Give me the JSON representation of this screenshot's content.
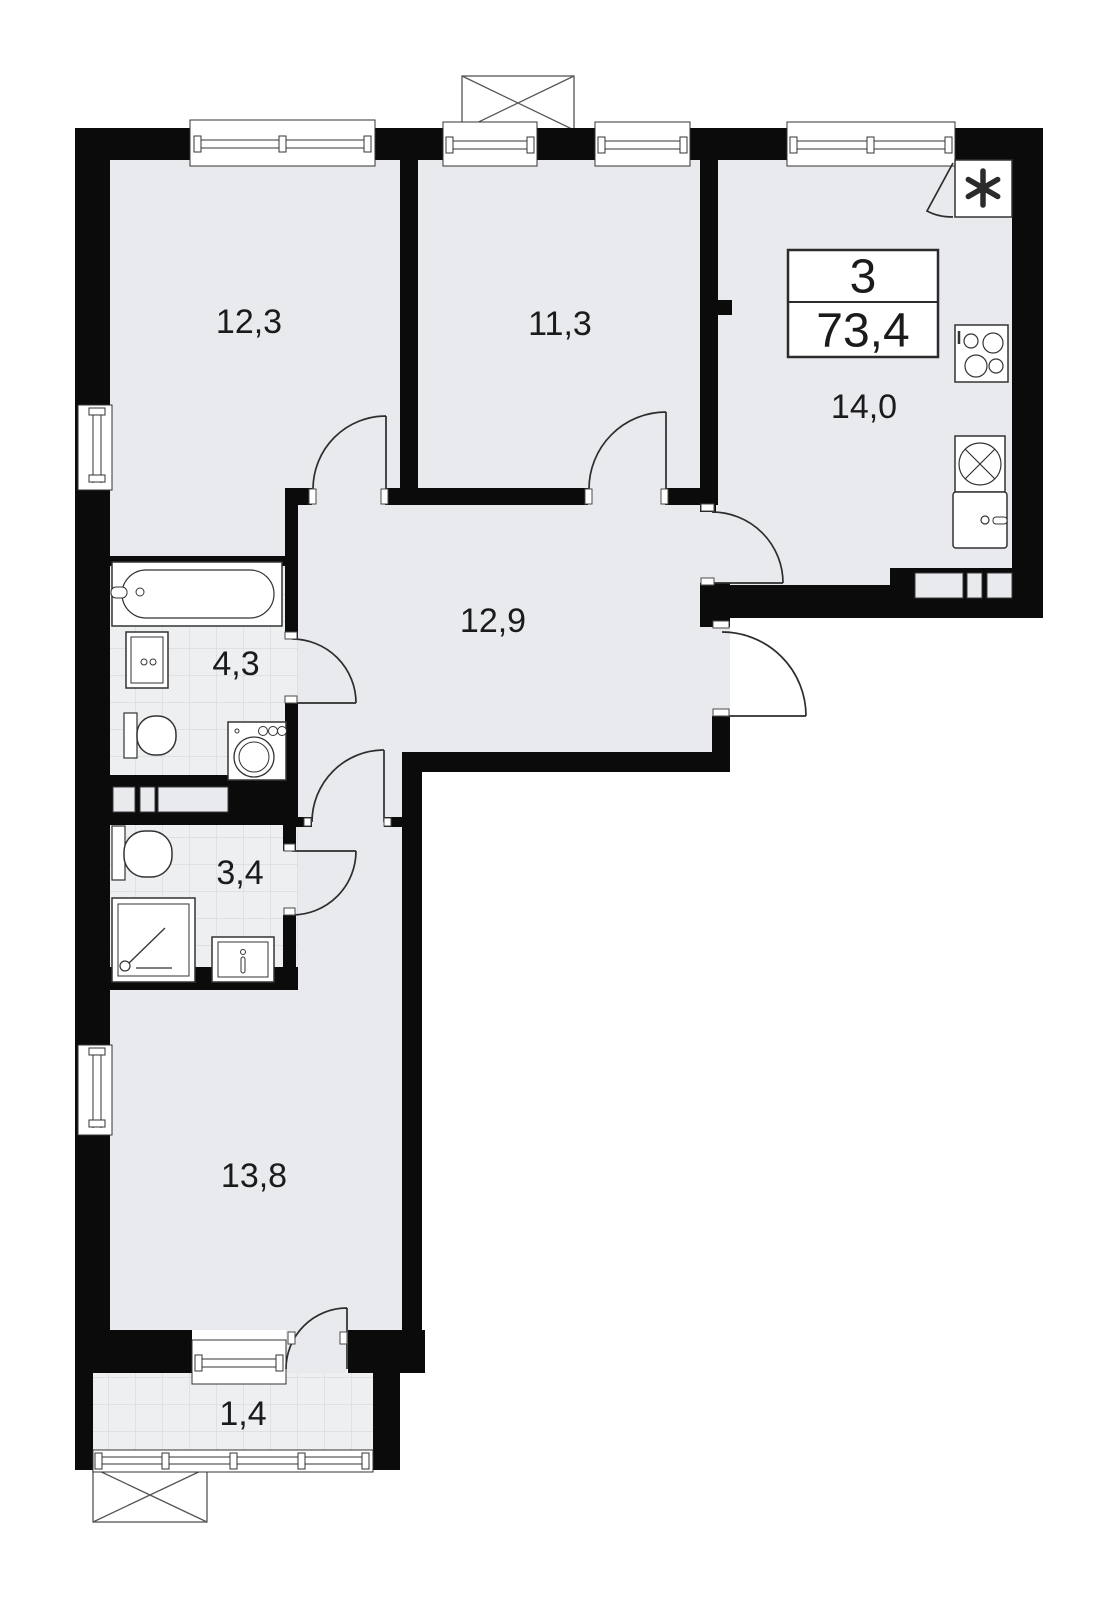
{
  "plan": {
    "type": "apartment-floor-plan",
    "badge": {
      "rooms_count": "3",
      "total_area": "73,4"
    },
    "rooms": {
      "room1": {
        "label": "12,3"
      },
      "room2": {
        "label": "11,3"
      },
      "kitchen": {
        "label": "14,0"
      },
      "corridor": {
        "label": "12,9"
      },
      "bathroom": {
        "label": "4,3"
      },
      "toilet": {
        "label": "3,4"
      },
      "room3": {
        "label": "13,8"
      },
      "balcony": {
        "label": "1,4"
      }
    },
    "colors": {
      "wall": "#0b0b0b",
      "floor": "#e8eaee",
      "tile": "#edeff1",
      "tile_line": "#d5d9dc",
      "stroke": "#333333",
      "outside": "#ffffff"
    },
    "icons": [
      "bathtub-icon",
      "sink-icon",
      "toilet-icon",
      "washing-machine-icon",
      "shower-icon",
      "stove-icon",
      "kitchen-sink-icon",
      "fridge-icon",
      "vent-shaft-icon",
      "ac-basket-icon",
      "window",
      "door-swing"
    ]
  }
}
